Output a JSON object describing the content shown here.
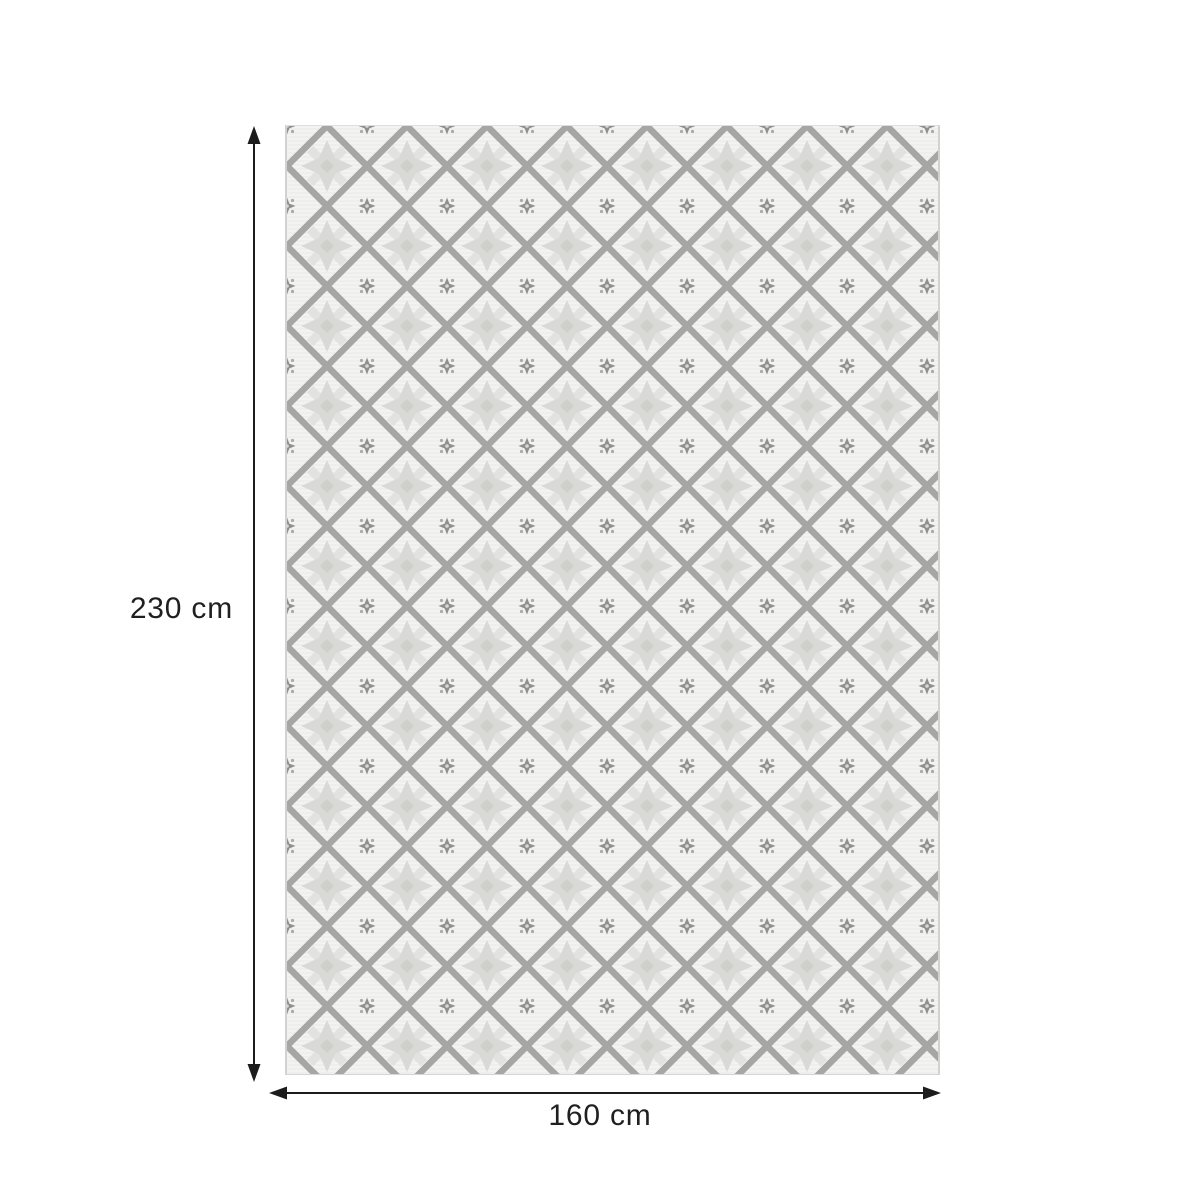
{
  "diagram": {
    "title": "rug-dimension-diagram",
    "height_label": "230 cm",
    "width_label": "160 cm",
    "height_cm": 230,
    "width_cm": 160,
    "arrow_color": "#1c1c1c",
    "label_color": "#1f1f1f"
  },
  "rug": {
    "description": "rectangular rug with interlocking geometric fret pattern",
    "colors": {
      "base": "#f3f3f1",
      "texture_line": "#eaeae7",
      "light_motif": "#e2e2df",
      "flower": "#d9d9d6",
      "flower_center": "#cfcfcc",
      "lattice": "#a6a6a4",
      "star": "#8f8f8f",
      "edge": "#d2d2d0"
    }
  }
}
